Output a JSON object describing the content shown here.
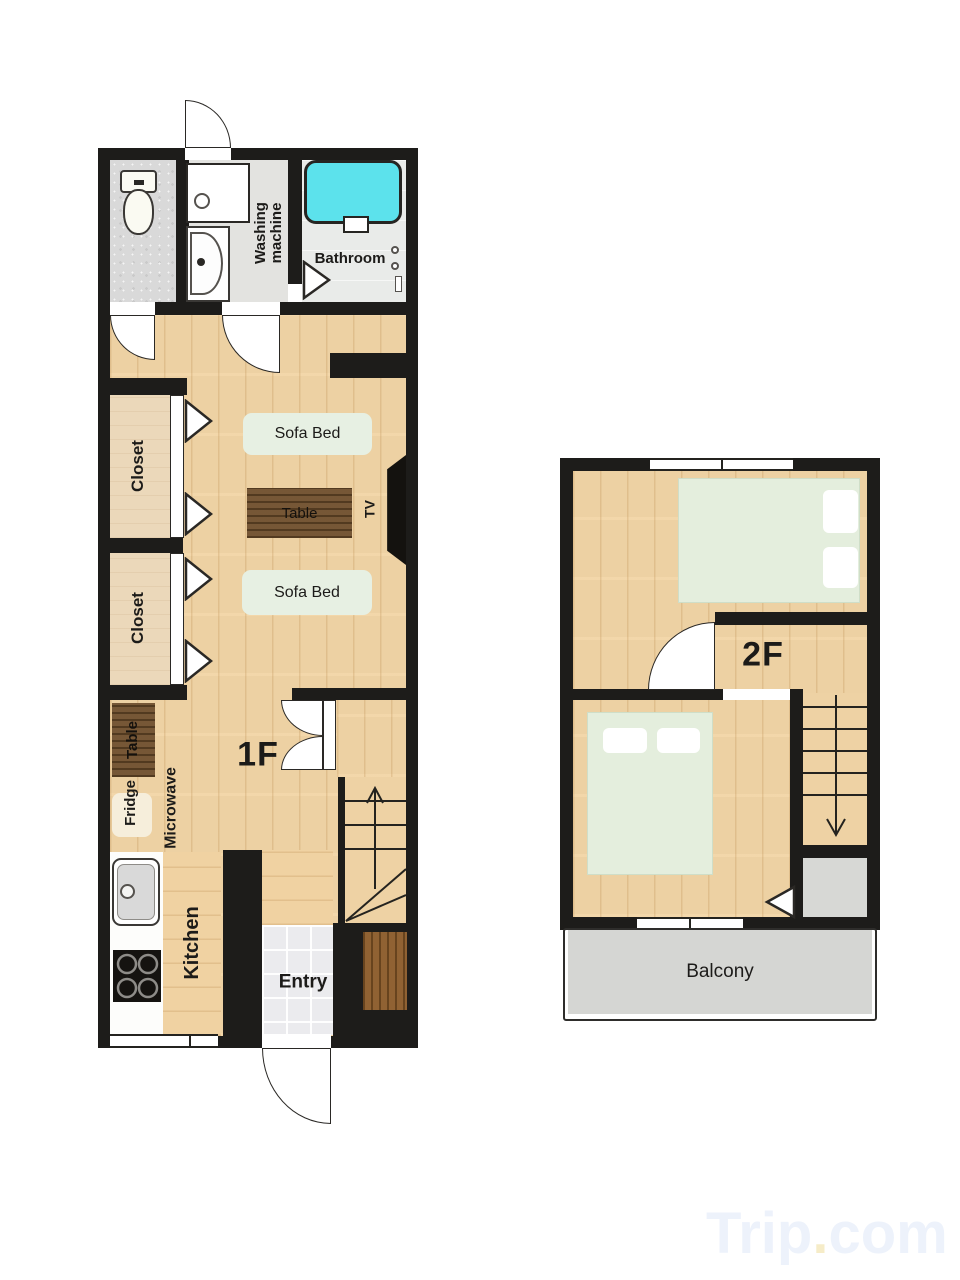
{
  "colors": {
    "wall": "#1d1c1a",
    "wood_floor": "#f2d5a6",
    "dark_wood": "#6e4d2a",
    "closet": "#ebd8ba",
    "sofa_bed": "#e7f0e3",
    "bed": "#e4eedd",
    "bathtub": "#5ce2ec",
    "balcony": "#d5d6d3",
    "entry_tile": "#ebebee",
    "step": "#8a5a28",
    "watermark_blue": "#edf2fb",
    "watermark_yellow": "#f6ecc8"
  },
  "floor1": {
    "title": "1F",
    "washing_machine_label": "Washing\nmachine",
    "bathroom_label": "Bathroom",
    "closet_top_label": "Closet",
    "closet_bottom_label": "Closet",
    "sofa_bed_top_label": "Sofa Bed",
    "table_label": "Table",
    "tv_label": "TV",
    "sofa_bed_bottom_label": "Sofa Bed",
    "kitchen_table_label": "Table",
    "fridge_label": "Fridge",
    "microwave_label": "Microwave",
    "kitchen_label": "Kitchen",
    "entry_label": "Entry"
  },
  "floor2": {
    "title": "2F",
    "balcony_label": "Balcony"
  },
  "watermark": {
    "brand": "Trip",
    "dot": ".",
    "suffix": "com"
  }
}
